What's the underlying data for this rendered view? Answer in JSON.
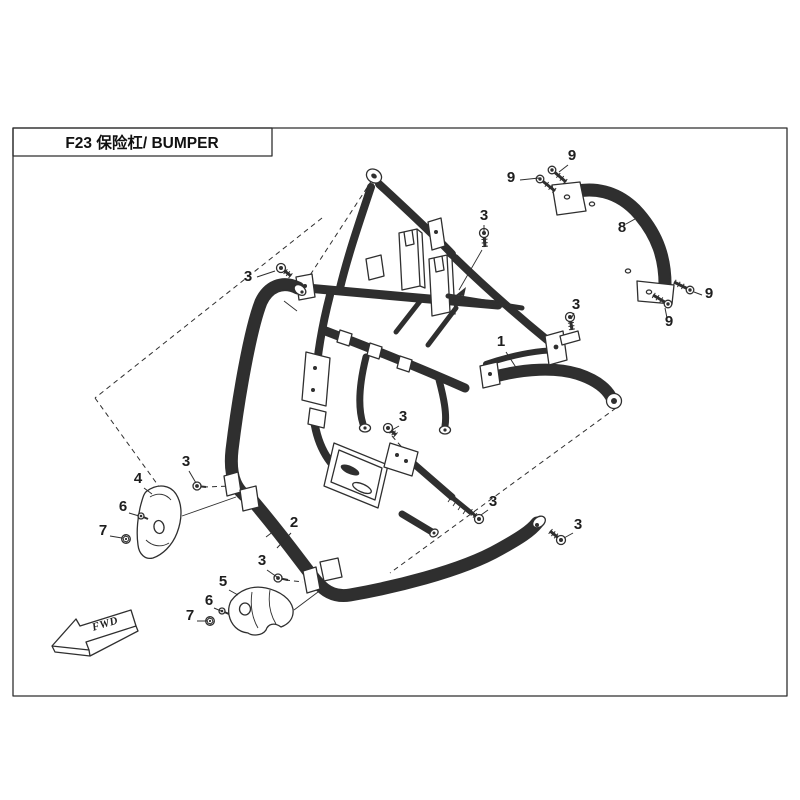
{
  "title_block": {
    "text": "F23  保险杠/ BUMPER"
  },
  "direction_indicator": {
    "label": "FWD"
  },
  "colors": {
    "line": "#2f2f2f",
    "background": "#ffffff"
  },
  "callouts": [
    {
      "label": "1",
      "x": 501,
      "y": 346,
      "leader": [
        506,
        352,
        517,
        369
      ]
    },
    {
      "label": "2",
      "x": 294,
      "y": 527,
      "leader": [
        291,
        533,
        277,
        548
      ]
    },
    {
      "label": "3",
      "x": 248,
      "y": 281,
      "leader": [
        257,
        277,
        275,
        271
      ]
    },
    {
      "label": "3",
      "x": 484,
      "y": 220,
      "leader": [
        484,
        225,
        484,
        232
      ]
    },
    {
      "label": "3",
      "x": 576,
      "y": 309,
      "leader": [
        574,
        313,
        571,
        319
      ]
    },
    {
      "label": "3",
      "x": 403,
      "y": 421,
      "leader": [
        399,
        426,
        392,
        430
      ]
    },
    {
      "label": "3",
      "x": 186,
      "y": 466,
      "leader": [
        189,
        471,
        196,
        483
      ]
    },
    {
      "label": "3",
      "x": 262,
      "y": 565,
      "leader": [
        267,
        570,
        277,
        577
      ]
    },
    {
      "label": "3",
      "x": 493,
      "y": 506,
      "leader": [
        488,
        510,
        481,
        515
      ]
    },
    {
      "label": "3",
      "x": 578,
      "y": 529,
      "leader": [
        573,
        533,
        564,
        538
      ]
    },
    {
      "label": "4",
      "x": 138,
      "y": 483,
      "leader": [
        144,
        488,
        152,
        494
      ]
    },
    {
      "label": "5",
      "x": 223,
      "y": 586,
      "leader": [
        229,
        590,
        238,
        595
      ]
    },
    {
      "label": "6",
      "x": 123,
      "y": 511,
      "leader": [
        129,
        513,
        139,
        516
      ]
    },
    {
      "label": "6",
      "x": 209,
      "y": 605,
      "leader": [
        214,
        608,
        221,
        611
      ]
    },
    {
      "label": "7",
      "x": 103,
      "y": 535,
      "leader": [
        110,
        536,
        122,
        538
      ]
    },
    {
      "label": "7",
      "x": 190,
      "y": 620,
      "leader": [
        197,
        621,
        207,
        621
      ]
    },
    {
      "label": "8",
      "x": 622,
      "y": 232,
      "leader": [
        626,
        224,
        644,
        214
      ]
    },
    {
      "label": "9",
      "x": 572,
      "y": 160,
      "leader": [
        568,
        165,
        559,
        172
      ]
    },
    {
      "label": "9",
      "x": 511,
      "y": 182,
      "leader": [
        520,
        180,
        539,
        178
      ]
    },
    {
      "label": "9",
      "x": 709,
      "y": 298,
      "leader": [
        702,
        295,
        694,
        292
      ]
    },
    {
      "label": "9",
      "x": 669,
      "y": 326,
      "leader": [
        667,
        318,
        665,
        308
      ]
    }
  ],
  "fasteners": [
    {
      "kind": "screw",
      "x": 552,
      "y": 170,
      "dx": 14,
      "dy": 12
    },
    {
      "kind": "screw",
      "x": 540,
      "y": 179,
      "dx": 15,
      "dy": 12
    },
    {
      "kind": "screw",
      "x": 690,
      "y": 290,
      "dx": -16,
      "dy": -8
    },
    {
      "kind": "screw",
      "x": 668,
      "y": 304,
      "dx": -15,
      "dy": -9
    },
    {
      "kind": "bolt",
      "x": 281,
      "y": 268,
      "dx": 10,
      "dy": 8
    },
    {
      "kind": "bolt",
      "x": 484,
      "y": 233,
      "dx": 1,
      "dy": 14
    },
    {
      "kind": "bolt",
      "x": 570,
      "y": 317,
      "dx": 2,
      "dy": 13
    },
    {
      "kind": "bolt",
      "x": 388,
      "y": 428,
      "dx": 8,
      "dy": 7
    },
    {
      "kind": "bolt",
      "x": 479,
      "y": 519,
      "dx": -9,
      "dy": -8
    },
    {
      "kind": "bolt",
      "x": 561,
      "y": 540,
      "dx": -11,
      "dy": -9
    },
    {
      "kind": "nut",
      "x": 197,
      "y": 486,
      "dx": 9,
      "dy": 1
    },
    {
      "kind": "nut",
      "x": 278,
      "y": 578,
      "dx": 10,
      "dy": 2
    },
    {
      "kind": "washer",
      "x": 141,
      "y": 516,
      "dx": 7,
      "dy": 3
    },
    {
      "kind": "washer",
      "x": 222,
      "y": 611,
      "dx": 7,
      "dy": 3
    },
    {
      "kind": "hexbolt",
      "x": 126,
      "y": 539,
      "dx": 0,
      "dy": 0
    },
    {
      "kind": "hexbolt",
      "x": 210,
      "y": 621,
      "dx": 0,
      "dy": 0
    }
  ]
}
